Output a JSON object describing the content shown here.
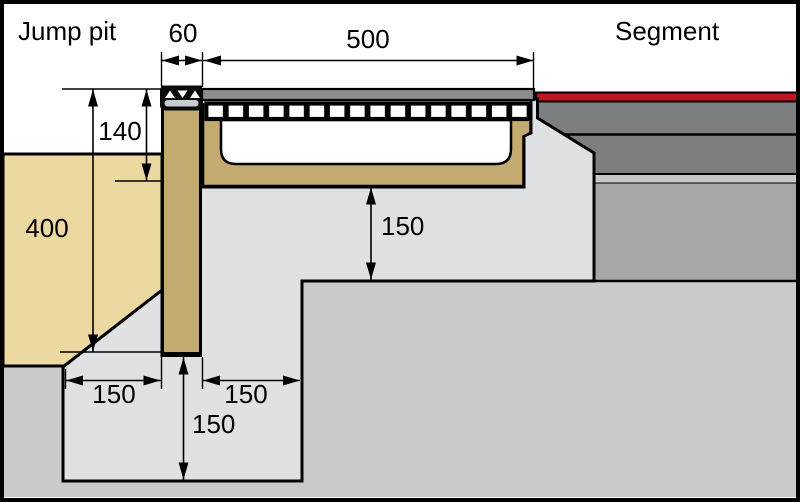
{
  "diagram": {
    "label_left": "Jump pit",
    "label_right": "Segment"
  },
  "dimensions": {
    "board_width_mm": "60",
    "channel_width_mm": "500",
    "surface_to_channel_base_mm": "140",
    "board_height_mm": "400",
    "bedding_under_channel_mm": "150",
    "ledge_left_mm": "150",
    "ledge_right_mm": "150",
    "foundation_depth_mm": "150"
  },
  "colors": {
    "sand": "#ECD9A1",
    "timber": "#C3AA70",
    "concrete": "#DFE1E3",
    "subsoil": "#C8CACC",
    "asphalt": "#7C7E80",
    "separator": "#C6C8CA",
    "base_course": "#A5A7A9",
    "track_red": "#C11622",
    "grate_frame": "#8B8D8F",
    "channel_interior": "#FFFFFF"
  }
}
